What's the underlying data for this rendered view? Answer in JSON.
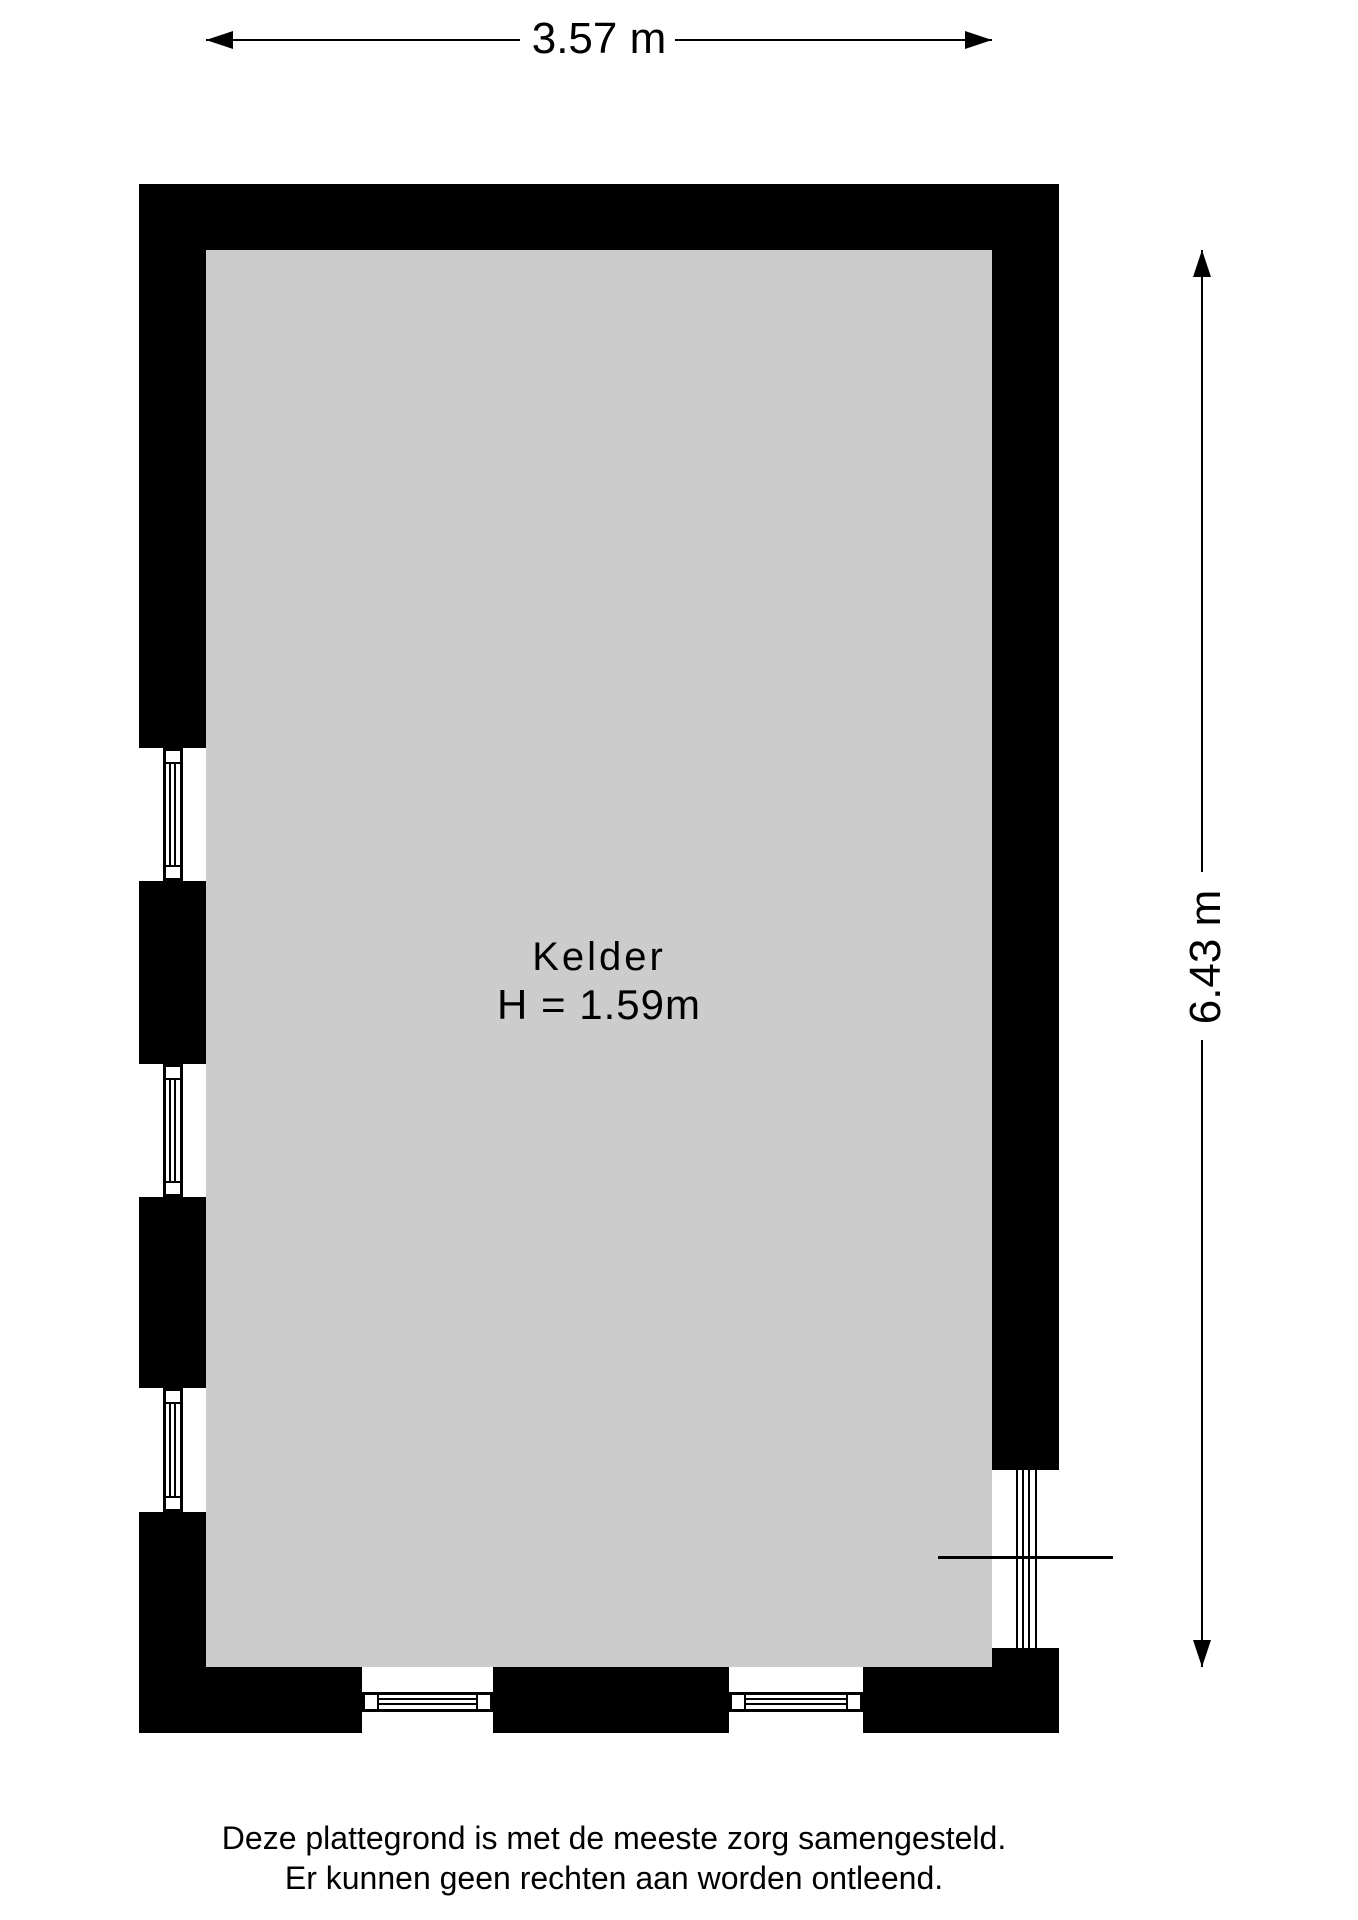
{
  "plan": {
    "room_label": "Kelder",
    "room_height_label": "H = 1.59m",
    "width_dimension": "3.57 m",
    "height_dimension": "6.43 m"
  },
  "disclaimer": {
    "line1": "Deze plattegrond is met de meeste zorg samengesteld.",
    "line2": "Er kunnen geen rechten aan worden ontleend."
  },
  "colors": {
    "wall": "#000000",
    "floor": "#cccccc",
    "line": "#000000",
    "background": "#ffffff"
  }
}
